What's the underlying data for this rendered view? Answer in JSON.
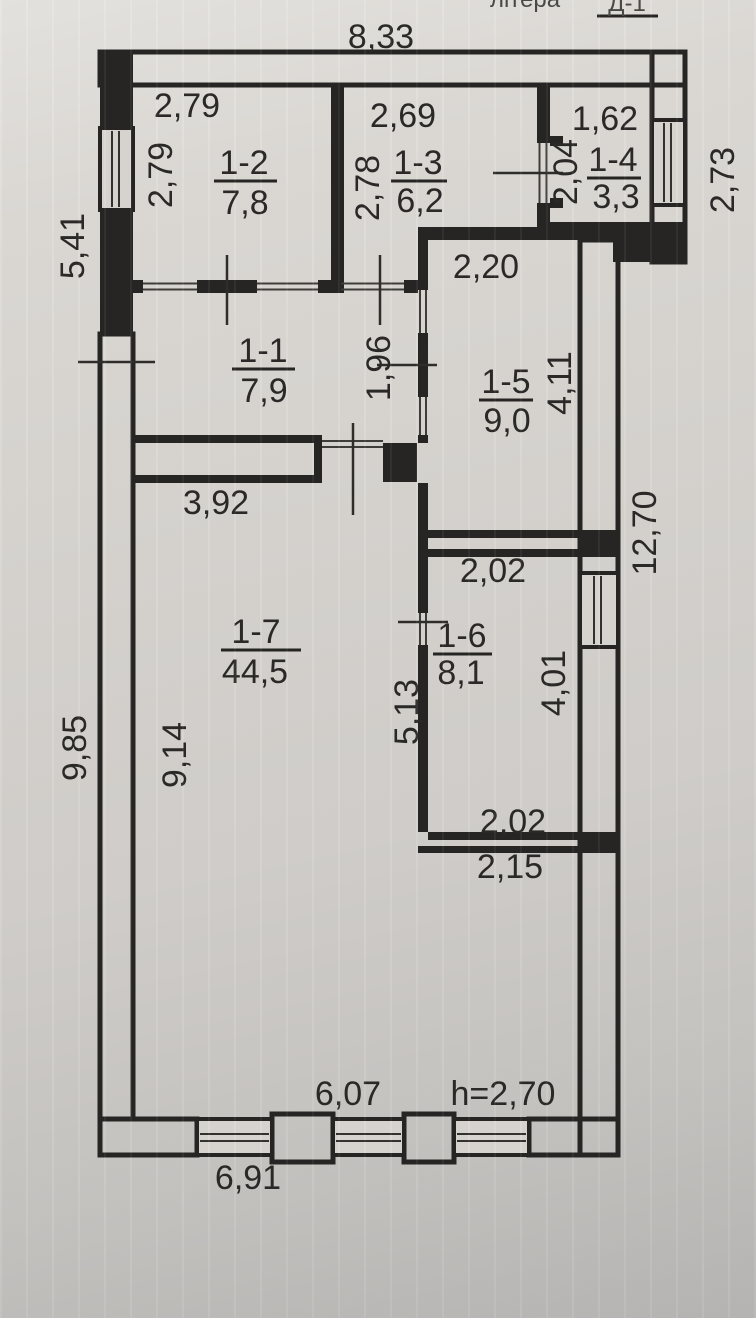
{
  "header": {
    "label": "літера",
    "value": "Д-1"
  },
  "exterior_dimensions": {
    "top": "8,33",
    "left_upper": "5,41",
    "left_lower": "9,85",
    "right_upper": "2,73",
    "right_main": "12,70",
    "bottom_outer": "6,91",
    "ceiling_height": "h=2,70"
  },
  "rooms": [
    {
      "id": "1-1",
      "area": "7,9",
      "dim_inner": "1,96"
    },
    {
      "id": "1-2",
      "area": "7,8",
      "dim_top": "2,79",
      "dim_left": "2,79"
    },
    {
      "id": "1-3",
      "area": "6,2",
      "dim_top": "2,69",
      "dim_left": "2,78"
    },
    {
      "id": "1-4",
      "area": "3,3",
      "dim_top": "1,62",
      "dim_left": "2,04"
    },
    {
      "id": "1-5",
      "area": "9,0",
      "dim_top": "2,20",
      "dim_right": "4,11"
    },
    {
      "id": "1-6",
      "area": "8,1",
      "dim_top": "2,02",
      "dim_right": "4,01",
      "dim_bottom": "2,02",
      "dim_left": "5,13",
      "dim_below": "2,15"
    },
    {
      "id": "1-7",
      "area": "44,5",
      "dim_top": "3,92",
      "dim_left": "9,14",
      "dim_bottom": "6,07"
    }
  ]
}
